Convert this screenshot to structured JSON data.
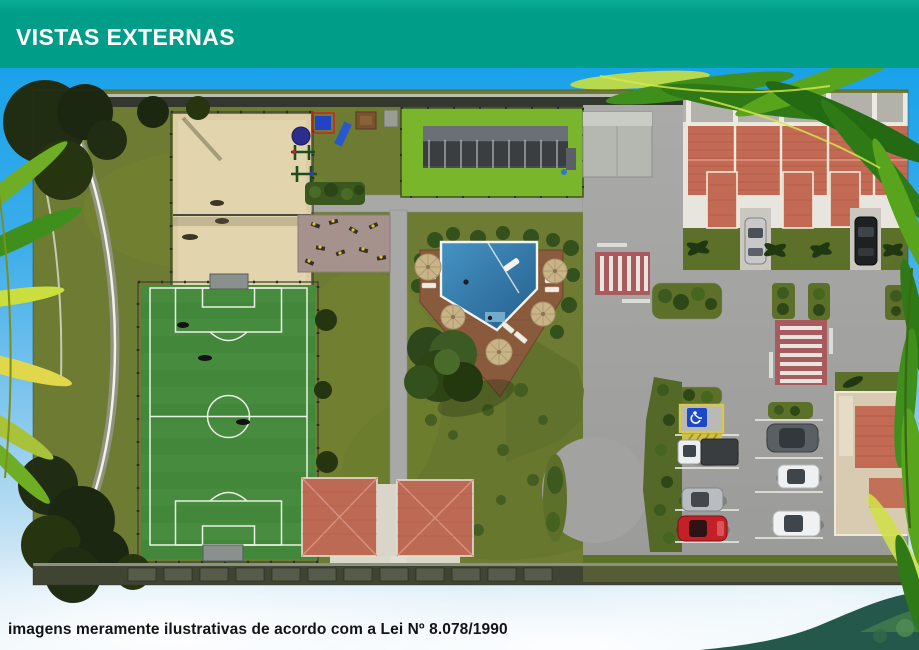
{
  "header": {
    "title": "VISTAS EXTERNAS",
    "background_color": "#009d88",
    "text_color": "#ffffff"
  },
  "footer": {
    "disclaimer": "imagens meramente ilustrativas de acordo com a Lei Nº 8.078/1990"
  },
  "scene": {
    "kind": "aerial-3d-site-plan-render",
    "features": [
      "soccer-field",
      "beach-volleyball-court",
      "playground",
      "outdoor-gym-area",
      "covered-bleachers-lawn",
      "swimming-pool",
      "pool-deck-umbrellas",
      "large-tree",
      "clubhouse-twin-roofs",
      "townhouse-row",
      "parking-lot",
      "accessible-parking-space",
      "crosswalk",
      "cul-de-sac-loop",
      "curved-perimeter-road",
      "palm-fronds",
      "hills"
    ],
    "colors": {
      "grass": "#6d7b33",
      "sport-turf": "#79b62c",
      "field-green": "#43883a",
      "sand": "#ddcda4",
      "pool-blue": "#2c6f9d",
      "deck-brown": "#8a5a3d",
      "roof-terracotta": "#c26a54",
      "road-gray": "#a2a2a0",
      "crosswalk-red": "#a85a5e",
      "accessible-sign-blue": "#1c49c8",
      "accessible-border-yellow": "#d8c84a"
    },
    "vehicle_colors": [
      "silver",
      "black",
      "white",
      "red",
      "dark-gray"
    ]
  }
}
